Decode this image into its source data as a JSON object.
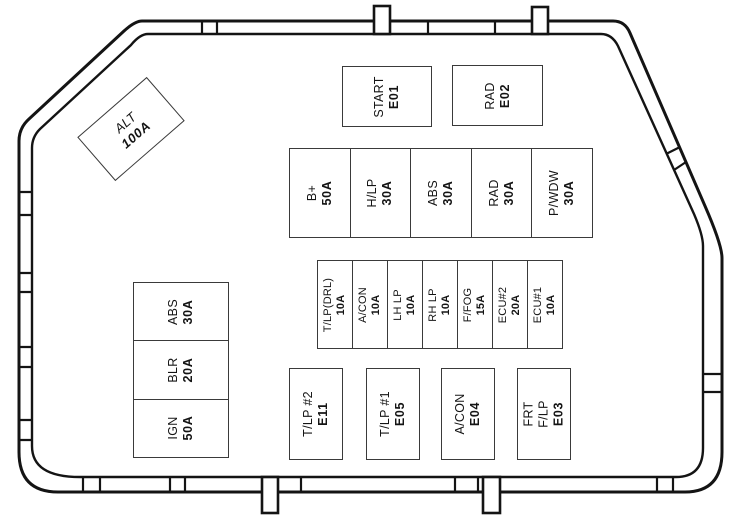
{
  "colors": {
    "line": "#141414",
    "box_border": "#3a3a3a",
    "background": "#ffffff",
    "text": "#141414"
  },
  "alt_fuse": {
    "label": "ALT",
    "value": "100A"
  },
  "top_relays": [
    {
      "label": "START",
      "value": "E01"
    },
    {
      "label": "RAD",
      "value": "E02"
    }
  ],
  "main_fuses": [
    {
      "label": "B+",
      "value": "50A"
    },
    {
      "label": "H/LP",
      "value": "30A"
    },
    {
      "label": "ABS",
      "value": "30A"
    },
    {
      "label": "RAD",
      "value": "30A"
    },
    {
      "label": "P/WDW",
      "value": "30A"
    }
  ],
  "mini_fuses": [
    {
      "label": "T/LP(DRL)",
      "value": "10A"
    },
    {
      "label": "A/CON",
      "value": "10A"
    },
    {
      "label": "LH LP",
      "value": "10A"
    },
    {
      "label": "RH LP",
      "value": "10A"
    },
    {
      "label": "F/FOG",
      "value": "15A"
    },
    {
      "label": "ECU#2",
      "value": "20A"
    },
    {
      "label": "ECU#1",
      "value": "10A"
    }
  ],
  "side_fuses": [
    {
      "label": "ABS",
      "value": "30A"
    },
    {
      "label": "BLR",
      "value": "20A"
    },
    {
      "label": "IGN",
      "value": "50A"
    }
  ],
  "bottom_relays": [
    {
      "lines": [
        "T/LP #2"
      ],
      "value": "E11"
    },
    {
      "lines": [
        "T/LP #1"
      ],
      "value": "E05"
    },
    {
      "lines": [
        "A/CON"
      ],
      "value": "E04"
    },
    {
      "lines": [
        "FRT",
        "F/LP"
      ],
      "value": "E03"
    }
  ]
}
